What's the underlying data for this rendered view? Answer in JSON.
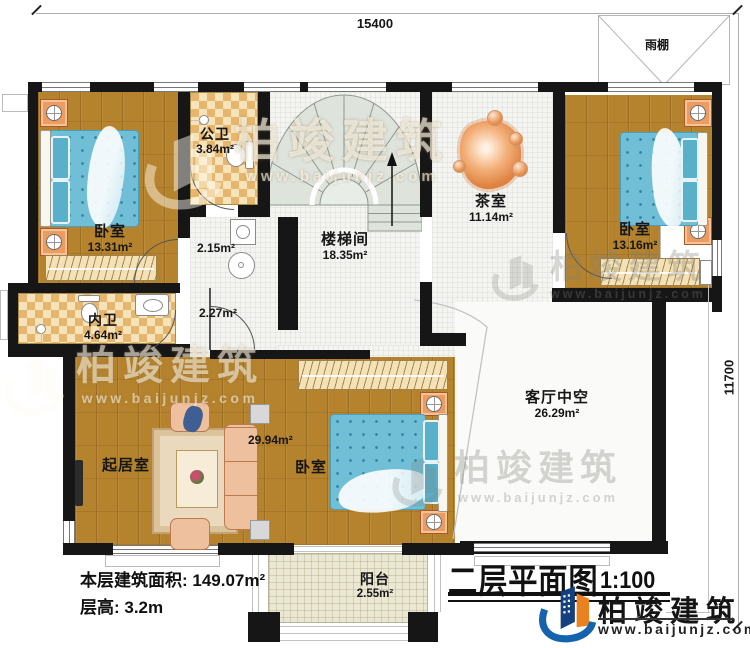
{
  "dimensions": {
    "width_mm": "15400",
    "height_mm": "11700"
  },
  "labels": {
    "canopy": "雨棚",
    "corridor_area_upper": "2.15m²",
    "corridor_area_lower": "2.27m²"
  },
  "rooms": {
    "bedroom_left": {
      "name": "卧室",
      "area": "13.31m²"
    },
    "public_bath": {
      "name": "公卫",
      "area": "3.84m²"
    },
    "stairwell": {
      "name": "楼梯间",
      "area": "18.35m²"
    },
    "tea_room": {
      "name": "茶室",
      "area": "11.14m²"
    },
    "bedroom_right": {
      "name": "卧室",
      "area": "13.16m²"
    },
    "inner_bath": {
      "name": "内卫",
      "area": "4.64m²"
    },
    "living_room": {
      "name": "起居室"
    },
    "bedroom_bottom": {
      "name": "卧室",
      "area": "29.94m²"
    },
    "living_void": {
      "name": "客厅中空",
      "area": "26.29m²"
    },
    "balcony": {
      "name": "阳台",
      "area": "2.55m²"
    }
  },
  "footer": {
    "floor_area": "本层建筑面积: 149.07m²",
    "floor_height": "层高: 3.2m"
  },
  "title": {
    "name": "二层平面图",
    "scale": "1:100"
  },
  "brand": {
    "name": "柏竣建筑",
    "url": "www.baijunjz.com"
  }
}
